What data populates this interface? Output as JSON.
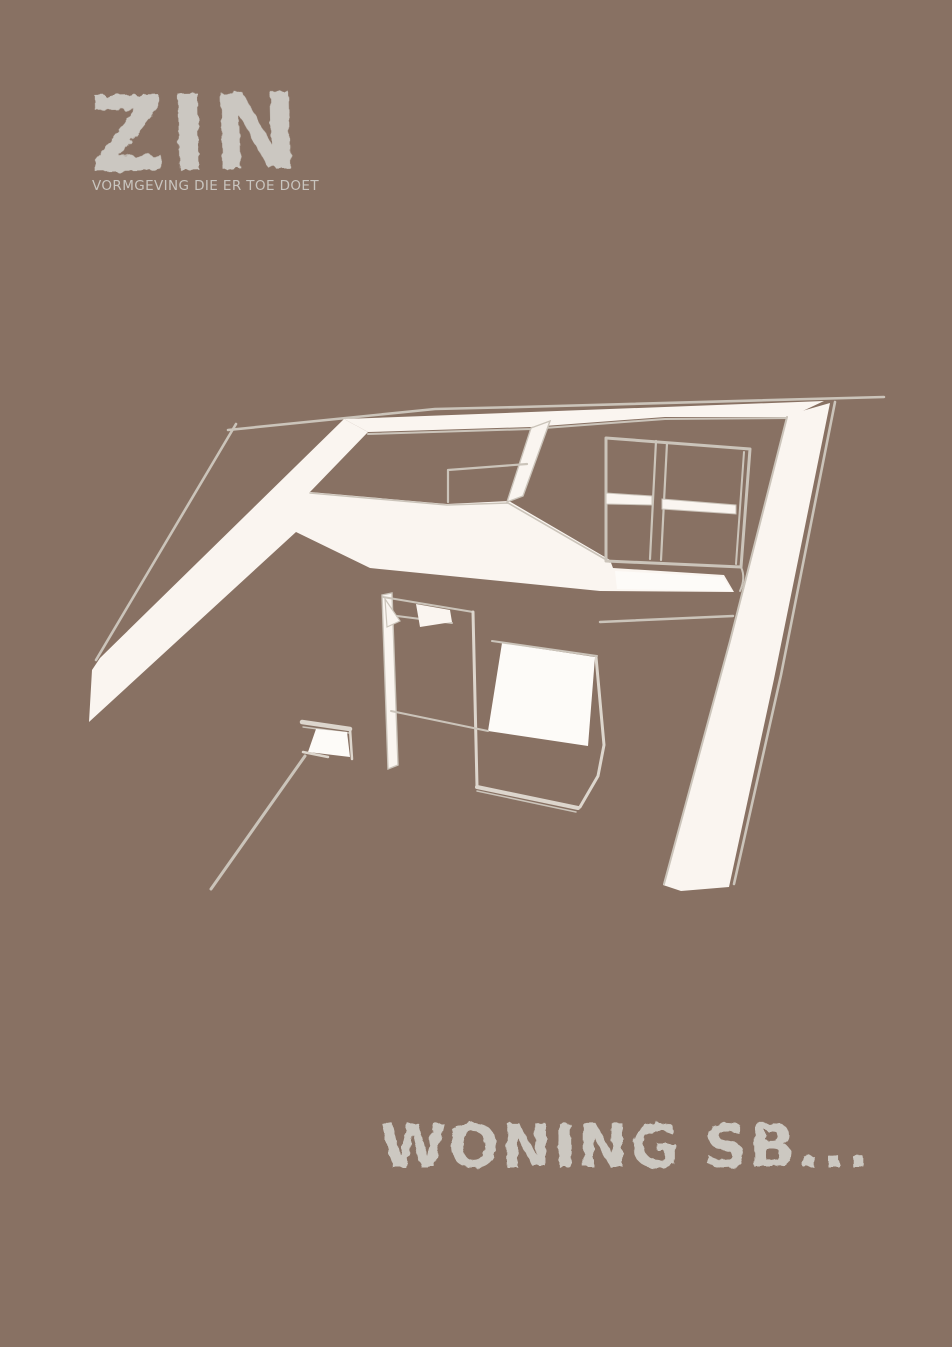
{
  "poster": {
    "background_color": "#887163",
    "sketch_ink_color": "#faf5f0",
    "sketch_line_color": "#cbc4ba",
    "text_color": "#cbc7c1"
  },
  "brand": {
    "logo_text": "ZIN",
    "tagline": "VORMGEVING DIE ER TOE DOET"
  },
  "illustration": {
    "label": "attic-interior-sketch"
  },
  "title": {
    "text": "WONING SB..."
  }
}
